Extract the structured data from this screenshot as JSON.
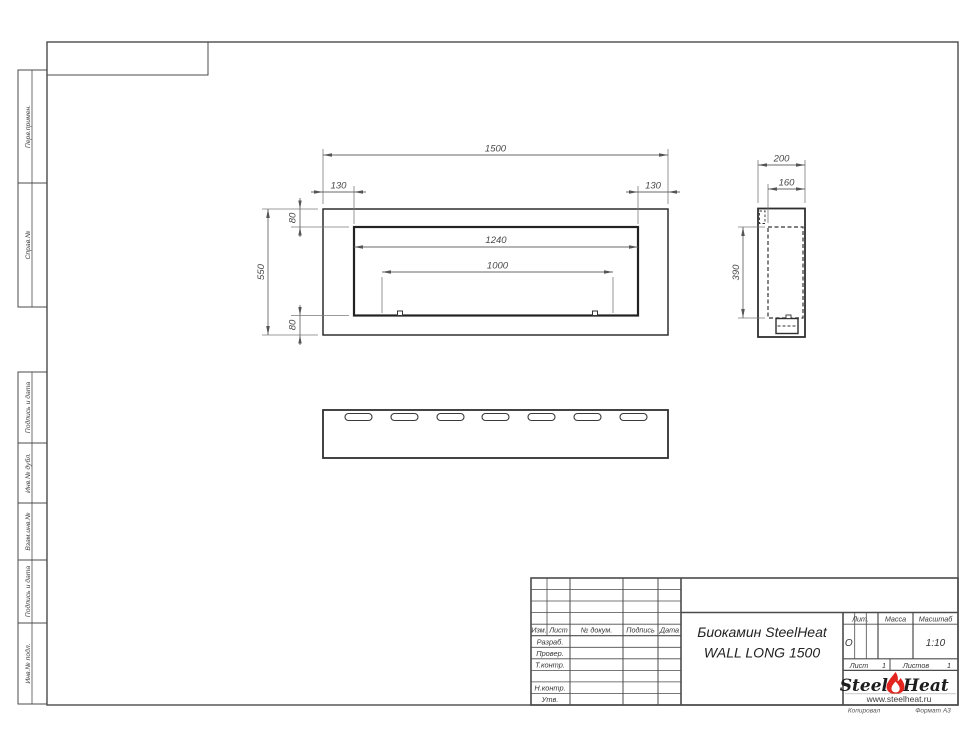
{
  "drawing": {
    "front_view": {
      "overall_width": "1500",
      "offset_left": "130",
      "offset_right": "130",
      "offset_top": "80",
      "offset_bottom": "80",
      "overall_height": "550",
      "opening_width": "1240",
      "burner_length": "1000"
    },
    "side_view": {
      "overall_depth": "200",
      "inner_depth": "160",
      "inner_height": "390"
    }
  },
  "margin_stamps": {
    "upper": [
      "Перв.примен.",
      "Справ.№"
    ],
    "lower": [
      "Подпись и дата",
      "Инв.№ дубл.",
      "Взам.инв.№",
      "Подпись и дата",
      "Инв.№ подл."
    ]
  },
  "title_block": {
    "header_cols": [
      "Изм.",
      "Лист",
      "№ докум.",
      "Подпись",
      "Дата"
    ],
    "role_rows": [
      "Разраб.",
      "Провер.",
      "Т.контр.",
      "Н.контр.",
      "Утв."
    ],
    "title_line1": "Биокамин SteelHeat",
    "title_line2": "WALL LONG 1500",
    "lit_label": "Лит.",
    "lit_value": "О",
    "massa_label": "Масса",
    "scale_label": "Масштаб",
    "scale_value": "1:10",
    "sheet_label": "Лист",
    "sheet_value": "1",
    "sheets_label": "Листов",
    "sheets_value": "1",
    "logo_steel": "Steel",
    "logo_heat": "Heat",
    "logo_url": "www.steelheat.ru",
    "footer_left": "Копировал",
    "footer_right": "Формат А3"
  },
  "colors": {
    "flame_red": "#e2251f",
    "line_dark": "#2f2f2f",
    "line_frame": "#4b4b4b"
  }
}
